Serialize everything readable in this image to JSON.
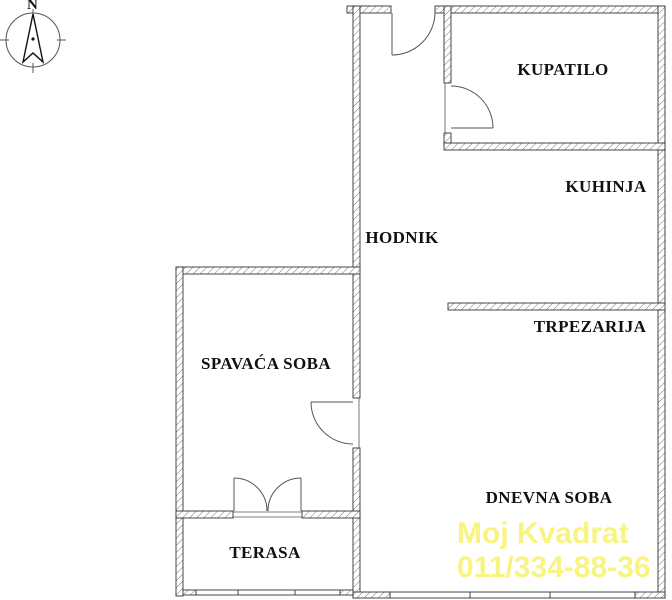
{
  "compass": {
    "north_label": "N"
  },
  "rooms": {
    "kupatilo": "KUPATILO",
    "kuhinja": "KUHINJA",
    "hodnik": "HODNIK",
    "trpezarija": "TRPEZARIJA",
    "spavaca_soba": "SPAVAĆA SOBA",
    "dnevna_soba": "DNEVNA SOBA",
    "terasa": "TERASA"
  },
  "watermark": {
    "brand": "Moj Kvadrat",
    "phone": "011/334-88-36",
    "color": "#F9F37F"
  },
  "colors": {
    "background": "#FFFFFF",
    "wall_outline": "#333333",
    "wall_hatch": "#777777",
    "door_line": "#555555",
    "label_text": "#111111"
  }
}
